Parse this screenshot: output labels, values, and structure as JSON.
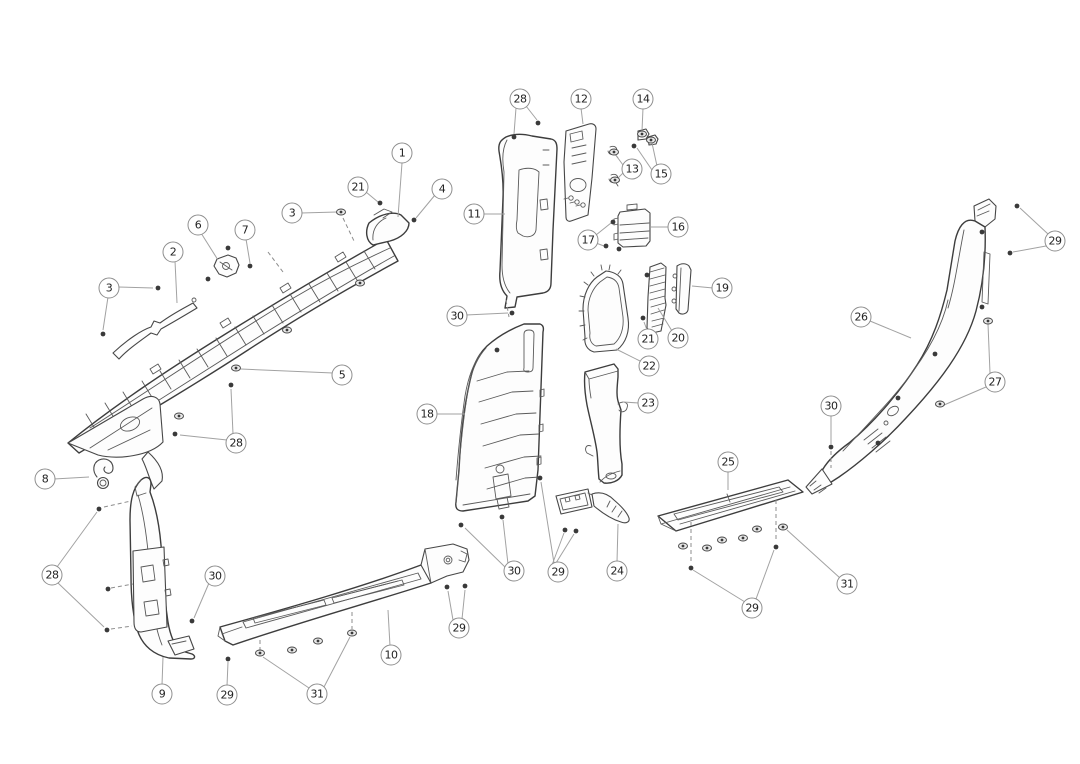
{
  "diagram": {
    "kind": "exploded-parts-line-drawing",
    "subject": "vehicle interior pillar and sill trim panels",
    "canvas": {
      "width": 1080,
      "height": 764,
      "background": "#ffffff"
    },
    "style": {
      "line_color": "#474747",
      "leader_color": "#a2a2a2",
      "dash_color": "#8c8c8c",
      "callout_border": "#8f8f8f",
      "callout_fill": "#ffffff",
      "callout_text": "#222222",
      "fastener_color": "#3a3a3a"
    },
    "callouts": [
      {
        "label": "1",
        "x": 402,
        "y": 153,
        "leaders": [
          [
            402,
            163,
            398,
            217
          ]
        ]
      },
      {
        "label": "21",
        "x": 358,
        "y": 187,
        "leaders": [
          [
            366,
            192,
            378,
            202
          ]
        ]
      },
      {
        "label": "4",
        "x": 442,
        "y": 189,
        "leaders": [
          [
            435,
            195,
            416,
            218
          ]
        ]
      },
      {
        "label": "3",
        "x": 292,
        "y": 213,
        "leaders": [
          [
            301,
            213,
            337,
            212
          ]
        ]
      },
      {
        "label": "6",
        "x": 198,
        "y": 225,
        "leaders": [
          [
            201,
            233,
            218,
            260
          ]
        ]
      },
      {
        "label": "7",
        "x": 245,
        "y": 230,
        "leaders": [
          [
            246,
            239,
            250,
            263
          ]
        ]
      },
      {
        "label": "2",
        "x": 173,
        "y": 252,
        "leaders": [
          [
            175,
            261,
            177,
            303
          ]
        ]
      },
      {
        "label": "3",
        "x": 109,
        "y": 288,
        "leaders": [
          [
            118,
            287,
            153,
            288
          ],
          [
            108,
            297,
            103,
            330
          ]
        ]
      },
      {
        "label": "5",
        "x": 342,
        "y": 375,
        "leaders": [
          [
            333,
            373,
            241,
            369
          ]
        ]
      },
      {
        "label": "28",
        "x": 236,
        "y": 443,
        "leaders": [
          [
            227,
            440,
            180,
            435
          ],
          [
            233,
            434,
            231,
            389
          ]
        ]
      },
      {
        "label": "28",
        "x": 520,
        "y": 99,
        "leaders": [
          [
            526,
            106,
            537,
            120
          ],
          [
            516,
            108,
            514,
            134
          ]
        ]
      },
      {
        "label": "12",
        "x": 581,
        "y": 99,
        "leaders": [
          [
            581,
            108,
            583,
            124
          ]
        ]
      },
      {
        "label": "14",
        "x": 643,
        "y": 99,
        "leaders": [
          [
            643,
            108,
            642,
            131
          ]
        ]
      },
      {
        "label": "13",
        "x": 632,
        "y": 169,
        "leaders": [
          [
            623,
            165,
            615,
            154
          ],
          [
            623,
            173,
            616,
            180
          ]
        ]
      },
      {
        "label": "15",
        "x": 661,
        "y": 174,
        "leaders": [
          [
            657,
            166,
            652,
            143
          ],
          [
            652,
            170,
            637,
            148
          ]
        ]
      },
      {
        "label": "11",
        "x": 474,
        "y": 214,
        "leaders": [
          [
            483,
            214,
            505,
            214
          ]
        ]
      },
      {
        "label": "17",
        "x": 588,
        "y": 240,
        "leaders": [
          [
            596,
            235,
            611,
            223
          ],
          [
            596,
            243,
            604,
            246
          ]
        ]
      },
      {
        "label": "16",
        "x": 678,
        "y": 227,
        "leaders": [
          [
            669,
            227,
            651,
            227
          ]
        ]
      },
      {
        "label": "30",
        "x": 457,
        "y": 316,
        "leaders": [
          [
            466,
            315,
            508,
            313
          ]
        ]
      },
      {
        "label": "19",
        "x": 722,
        "y": 288,
        "leaders": [
          [
            713,
            288,
            692,
            286
          ]
        ]
      },
      {
        "label": "20",
        "x": 678,
        "y": 338,
        "leaders": [
          [
            672,
            331,
            658,
            308
          ]
        ]
      },
      {
        "label": "21",
        "x": 648,
        "y": 339,
        "leaders": [
          [
            647,
            330,
            644,
            322
          ]
        ]
      },
      {
        "label": "22",
        "x": 649,
        "y": 366,
        "leaders": [
          [
            640,
            361,
            616,
            349
          ]
        ]
      },
      {
        "label": "23",
        "x": 648,
        "y": 403,
        "leaders": [
          [
            639,
            403,
            623,
            402
          ]
        ]
      },
      {
        "label": "18",
        "x": 427,
        "y": 414,
        "leaders": [
          [
            436,
            414,
            465,
            414
          ]
        ]
      },
      {
        "label": "29",
        "x": 1055,
        "y": 241,
        "leaders": [
          [
            1048,
            234,
            1020,
            208
          ],
          [
            1046,
            246,
            1013,
            252
          ]
        ]
      },
      {
        "label": "26",
        "x": 861,
        "y": 317,
        "leaders": [
          [
            870,
            321,
            911,
            338
          ]
        ]
      },
      {
        "label": "27",
        "x": 995,
        "y": 382,
        "leaders": [
          [
            990,
            373,
            988,
            324
          ],
          [
            986,
            387,
            944,
            405
          ]
        ]
      },
      {
        "label": "30",
        "x": 831,
        "y": 406,
        "leaders": [
          [
            831,
            415,
            831,
            444
          ]
        ]
      },
      {
        "label": "25",
        "x": 728,
        "y": 462,
        "leaders": [
          [
            728,
            471,
            728,
            490
          ]
        ]
      },
      {
        "label": "31",
        "x": 847,
        "y": 584,
        "leaders": [
          [
            840,
            578,
            787,
            530
          ]
        ]
      },
      {
        "label": "29",
        "x": 752,
        "y": 608,
        "leaders": [
          [
            745,
            602,
            693,
            570
          ],
          [
            756,
            599,
            774,
            550
          ]
        ]
      },
      {
        "label": "8",
        "x": 45,
        "y": 479,
        "leaders": [
          [
            54,
            479,
            89,
            477
          ]
        ]
      },
      {
        "label": "28",
        "x": 52,
        "y": 575,
        "leaders": [
          [
            57,
            567,
            97,
            512
          ],
          [
            58,
            583,
            104,
            627
          ]
        ]
      },
      {
        "label": "30",
        "x": 215,
        "y": 576,
        "leaders": [
          [
            209,
            583,
            194,
            618
          ]
        ]
      },
      {
        "label": "9",
        "x": 162,
        "y": 694,
        "leaders": [
          [
            162,
            685,
            163,
            657
          ]
        ]
      },
      {
        "label": "29",
        "x": 227,
        "y": 695,
        "leaders": [
          [
            227,
            686,
            228,
            662
          ]
        ]
      },
      {
        "label": "31",
        "x": 317,
        "y": 694,
        "leaders": [
          [
            309,
            688,
            263,
            657
          ],
          [
            324,
            687,
            350,
            637
          ]
        ]
      },
      {
        "label": "10",
        "x": 391,
        "y": 655,
        "leaders": [
          [
            390,
            646,
            388,
            610
          ]
        ]
      },
      {
        "label": "29",
        "x": 459,
        "y": 628,
        "leaders": [
          [
            453,
            620,
            448,
            591
          ],
          [
            462,
            619,
            465,
            590
          ]
        ]
      },
      {
        "label": "30",
        "x": 514,
        "y": 571,
        "leaders": [
          [
            508,
            564,
            503,
            520
          ],
          [
            505,
            567,
            465,
            528
          ]
        ]
      },
      {
        "label": "29",
        "x": 558,
        "y": 572,
        "leaders": [
          [
            554,
            563,
            541,
            482
          ],
          [
            552,
            565,
            564,
            533
          ],
          [
            556,
            563,
            574,
            534
          ]
        ]
      },
      {
        "label": "24",
        "x": 617,
        "y": 571,
        "leaders": [
          [
            617,
            562,
            618,
            524
          ]
        ]
      }
    ],
    "fasteners": [
      {
        "type": "screw",
        "x": 380,
        "y": 203
      },
      {
        "type": "screw",
        "x": 414,
        "y": 220
      },
      {
        "type": "screw",
        "x": 250,
        "y": 266
      },
      {
        "type": "screw",
        "x": 228,
        "y": 248
      },
      {
        "type": "screw",
        "x": 208,
        "y": 279
      },
      {
        "type": "screw",
        "x": 158,
        "y": 288
      },
      {
        "type": "screw",
        "x": 103,
        "y": 334
      },
      {
        "type": "screw",
        "x": 175,
        "y": 434
      },
      {
        "type": "screw",
        "x": 231,
        "y": 385
      },
      {
        "type": "screw",
        "x": 538,
        "y": 123
      },
      {
        "type": "screw",
        "x": 514,
        "y": 137
      },
      {
        "type": "screw",
        "x": 634,
        "y": 146
      },
      {
        "type": "screw",
        "x": 613,
        "y": 222
      },
      {
        "type": "screw",
        "x": 606,
        "y": 246
      },
      {
        "type": "screw",
        "x": 619,
        "y": 249
      },
      {
        "type": "screw",
        "x": 512,
        "y": 313
      },
      {
        "type": "screw",
        "x": 643,
        "y": 318
      },
      {
        "type": "screw",
        "x": 647,
        "y": 275
      },
      {
        "type": "screw",
        "x": 1017,
        "y": 206
      },
      {
        "type": "screw",
        "x": 1010,
        "y": 253
      },
      {
        "type": "screw",
        "x": 982,
        "y": 232
      },
      {
        "type": "screw",
        "x": 982,
        "y": 307
      },
      {
        "type": "screw",
        "x": 935,
        "y": 354
      },
      {
        "type": "screw",
        "x": 898,
        "y": 398
      },
      {
        "type": "screw",
        "x": 878,
        "y": 443
      },
      {
        "type": "screw",
        "x": 831,
        "y": 447
      },
      {
        "type": "screw",
        "x": 691,
        "y": 568
      },
      {
        "type": "screw",
        "x": 776,
        "y": 547
      },
      {
        "type": "screw",
        "x": 99,
        "y": 509
      },
      {
        "type": "screw",
        "x": 108,
        "y": 589
      },
      {
        "type": "screw",
        "x": 107,
        "y": 630
      },
      {
        "type": "screw",
        "x": 192,
        "y": 621
      },
      {
        "type": "screw",
        "x": 228,
        "y": 659
      },
      {
        "type": "screw",
        "x": 447,
        "y": 587
      },
      {
        "type": "screw",
        "x": 465,
        "y": 586
      },
      {
        "type": "screw",
        "x": 502,
        "y": 517
      },
      {
        "type": "screw",
        "x": 461,
        "y": 525
      },
      {
        "type": "screw",
        "x": 565,
        "y": 530
      },
      {
        "type": "screw",
        "x": 576,
        "y": 531
      },
      {
        "type": "screw",
        "x": 540,
        "y": 478
      },
      {
        "type": "screw",
        "x": 497,
        "y": 350
      },
      {
        "type": "clip",
        "x": 341,
        "y": 212
      },
      {
        "type": "clip",
        "x": 236,
        "y": 368
      },
      {
        "type": "clip",
        "x": 287,
        "y": 330
      },
      {
        "type": "clip",
        "x": 360,
        "y": 283
      },
      {
        "type": "clip",
        "x": 179,
        "y": 416
      },
      {
        "type": "clip",
        "x": 642,
        "y": 134
      },
      {
        "type": "clip",
        "x": 614,
        "y": 152
      },
      {
        "type": "clip",
        "x": 615,
        "y": 180
      },
      {
        "type": "clip",
        "x": 651,
        "y": 140
      },
      {
        "type": "clip",
        "x": 988,
        "y": 321
      },
      {
        "type": "clip",
        "x": 940,
        "y": 404
      },
      {
        "type": "clip",
        "x": 683,
        "y": 546
      },
      {
        "type": "clip",
        "x": 707,
        "y": 548
      },
      {
        "type": "clip",
        "x": 722,
        "y": 540
      },
      {
        "type": "clip",
        "x": 743,
        "y": 538
      },
      {
        "type": "clip",
        "x": 757,
        "y": 529
      },
      {
        "type": "clip",
        "x": 783,
        "y": 527
      },
      {
        "type": "clip",
        "x": 260,
        "y": 653
      },
      {
        "type": "clip",
        "x": 292,
        "y": 650
      },
      {
        "type": "clip",
        "x": 318,
        "y": 641
      },
      {
        "type": "clip",
        "x": 352,
        "y": 633
      }
    ],
    "dashed_lines": [
      [
        343,
        218,
        355,
        243
      ],
      [
        268,
        252,
        283,
        272
      ],
      [
        506,
        300,
        509,
        317
      ],
      [
        831,
        451,
        831,
        468
      ],
      [
        691,
        522,
        691,
        561
      ],
      [
        776,
        500,
        776,
        542
      ],
      [
        352,
        612,
        352,
        629
      ],
      [
        260,
        640,
        260,
        650
      ],
      [
        104,
        507,
        131,
        501
      ],
      [
        111,
        588,
        133,
        584
      ],
      [
        111,
        629,
        132,
        626
      ]
    ]
  }
}
